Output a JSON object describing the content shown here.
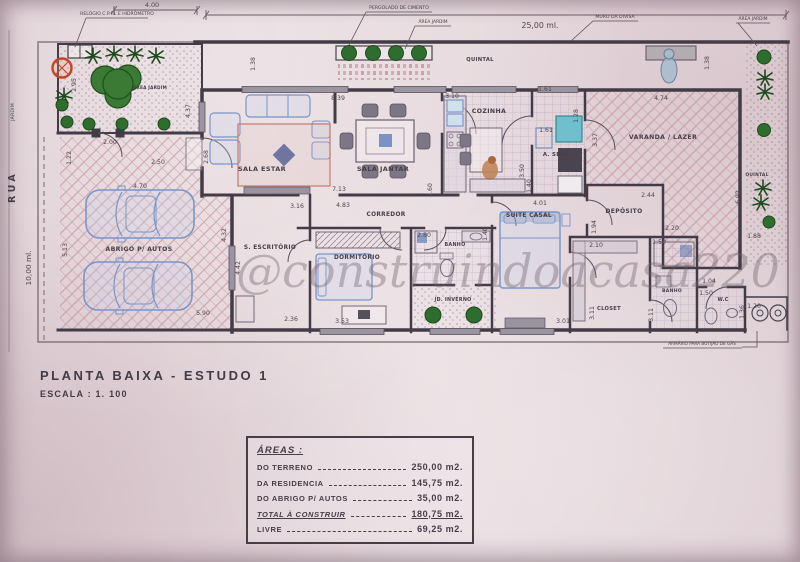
{
  "title_block": {
    "title": "PLANTA BAIXA - ESTUDO 1",
    "scale": "ESCALA : 1. 100"
  },
  "watermark": {
    "text": "@construindoacasa220"
  },
  "areas_table": {
    "heading": "ÁREAS :",
    "rows": [
      {
        "label": "DO TERRENO",
        "value": "250,00 m2.",
        "emphasis": false
      },
      {
        "label": "DA RESIDENCIA",
        "value": "145,75 m2.",
        "emphasis": false
      },
      {
        "label": "DO ABRIGO P/ AUTOS",
        "value": "35,00 m2.",
        "emphasis": false
      },
      {
        "label": "TOTAL À CONSTRUIR",
        "value": "180,75 m2.",
        "emphasis": true
      },
      {
        "label": "LIVRE",
        "value": "69,25 m2.",
        "emphasis": false
      }
    ]
  },
  "plan": {
    "room_labels": [
      {
        "name": "room-label-sala-estar",
        "text": "SALA ESTAR",
        "x": 262,
        "y": 171,
        "size": 6.5
      },
      {
        "name": "room-label-sala-jantar",
        "text": "SALA JANTAR",
        "x": 383,
        "y": 171,
        "size": 6.5
      },
      {
        "name": "room-label-cozinha",
        "text": "COZINHA",
        "x": 489,
        "y": 113,
        "size": 6.2
      },
      {
        "name": "room-label-a-serv",
        "text": "A. SERV",
        "x": 556,
        "y": 156,
        "size": 5.4
      },
      {
        "name": "room-label-varanda",
        "text": "VARANDA / LAZER",
        "x": 663,
        "y": 139,
        "size": 6.2
      },
      {
        "name": "room-label-deposito",
        "text": "DEPÓSITO",
        "x": 624,
        "y": 213,
        "size": 6.0
      },
      {
        "name": "room-label-corredor",
        "text": "CORREDOR",
        "x": 386,
        "y": 216,
        "size": 5.8
      },
      {
        "name": "room-label-escritorio",
        "text": "S. ESCRITÓRIO",
        "x": 270,
        "y": 249,
        "size": 5.8
      },
      {
        "name": "room-label-dormitorio",
        "text": "DORMITÓRIO",
        "x": 357,
        "y": 259,
        "size": 5.8
      },
      {
        "name": "room-label-suite-casal",
        "text": "SUITE CASAL",
        "x": 529,
        "y": 217,
        "size": 5.8
      },
      {
        "name": "room-label-banho-1",
        "text": "BANHO",
        "x": 455,
        "y": 246,
        "size": 4.8
      },
      {
        "name": "room-label-jd-inverno",
        "text": "JD. INVERNO",
        "x": 453,
        "y": 301,
        "size": 4.8
      },
      {
        "name": "room-label-closet",
        "text": "CLOSET",
        "x": 609,
        "y": 310,
        "size": 5.2
      },
      {
        "name": "room-label-banho-2",
        "text": "BANHO",
        "x": 672,
        "y": 292,
        "size": 4.6
      },
      {
        "name": "room-label-wc",
        "text": "W.C",
        "x": 723,
        "y": 301,
        "size": 4.8
      },
      {
        "name": "room-label-abrigo-autos",
        "text": "ABRIGO P/ AUTOS",
        "x": 139,
        "y": 251,
        "size": 6.2
      },
      {
        "name": "room-label-quintal-top",
        "text": "QUINTAL",
        "x": 480,
        "y": 61,
        "size": 5.2
      },
      {
        "name": "room-label-quintal-right",
        "text": "QUINTAL",
        "x": 757,
        "y": 176,
        "size": 4.4
      },
      {
        "name": "room-label-area-jardim",
        "text": "ÁREA JARDIM",
        "x": 150,
        "y": 89,
        "size": 4.2
      }
    ],
    "dimension_labels": [
      {
        "text": "4.00",
        "x": 152,
        "y": 7,
        "rot": 0,
        "size": 6.4
      },
      {
        "text": "25,00 ml.",
        "x": 540,
        "y": 28,
        "rot": 0,
        "size": 7.8
      },
      {
        "text": "10,00 ml.",
        "x": 31,
        "y": 268,
        "rot": -90,
        "size": 7.4
      },
      {
        "text": "2.95",
        "x": 76,
        "y": 85,
        "rot": -90,
        "size": 6.2
      },
      {
        "text": "4.37",
        "x": 190,
        "y": 111,
        "rot": -90,
        "size": 6.2
      },
      {
        "text": "1.38",
        "x": 255,
        "y": 64,
        "rot": -90,
        "size": 6.2
      },
      {
        "text": "2.00",
        "x": 110,
        "y": 144,
        "rot": 0,
        "size": 6.2
      },
      {
        "text": "2.50",
        "x": 158,
        "y": 164,
        "rot": 0,
        "size": 6.2
      },
      {
        "text": "1.22",
        "x": 71,
        "y": 158,
        "rot": -90,
        "size": 6.2
      },
      {
        "text": "4.70",
        "x": 140,
        "y": 188,
        "rot": 0,
        "size": 6.2
      },
      {
        "text": "2.68",
        "x": 208,
        "y": 157,
        "rot": -90,
        "size": 6.2
      },
      {
        "text": "5.13",
        "x": 67,
        "y": 250,
        "rot": -90,
        "size": 6.2
      },
      {
        "text": "4.32",
        "x": 226,
        "y": 235,
        "rot": -90,
        "size": 6.2
      },
      {
        "text": "4.42",
        "x": 240,
        "y": 268,
        "rot": -90,
        "size": 6.2
      },
      {
        "text": "5.90",
        "x": 203,
        "y": 315,
        "rot": 0,
        "size": 6.2
      },
      {
        "text": "2.36",
        "x": 291,
        "y": 321,
        "rot": 0,
        "size": 6.2
      },
      {
        "text": "8.39",
        "x": 338,
        "y": 100,
        "rot": 0,
        "size": 6.2
      },
      {
        "text": "3.16",
        "x": 297,
        "y": 208,
        "rot": 0,
        "size": 6.2
      },
      {
        "text": "4.83",
        "x": 343,
        "y": 207,
        "rot": 0,
        "size": 6.2
      },
      {
        "text": "7.13",
        "x": 339,
        "y": 191,
        "rot": 0,
        "size": 6.2
      },
      {
        "text": "3.10",
        "x": 452,
        "y": 98,
        "rot": 0,
        "size": 6.2
      },
      {
        "text": "3.60",
        "x": 432,
        "y": 190,
        "rot": -90,
        "size": 6.2
      },
      {
        "text": "1.61",
        "x": 545,
        "y": 91,
        "rot": 0,
        "size": 6.2
      },
      {
        "text": "1.61",
        "x": 546,
        "y": 132,
        "rot": 0,
        "size": 6.2
      },
      {
        "text": "1.28",
        "x": 578,
        "y": 116,
        "rot": -90,
        "size": 6.2
      },
      {
        "text": "3.50",
        "x": 524,
        "y": 171,
        "rot": -90,
        "size": 6.2
      },
      {
        "text": "1.40",
        "x": 531,
        "y": 186,
        "rot": -90,
        "size": 6.2
      },
      {
        "text": "3.37",
        "x": 597,
        "y": 140,
        "rot": -90,
        "size": 6.2
      },
      {
        "text": "4.01",
        "x": 540,
        "y": 205,
        "rot": 0,
        "size": 6.2
      },
      {
        "text": "1.40",
        "x": 487,
        "y": 234,
        "rot": -90,
        "size": 6.2
      },
      {
        "text": "2.80",
        "x": 424,
        "y": 237,
        "rot": 0,
        "size": 6.2
      },
      {
        "text": "3.53",
        "x": 342,
        "y": 323,
        "rot": 0,
        "size": 6.2
      },
      {
        "text": "4.74",
        "x": 661,
        "y": 100,
        "rot": 0,
        "size": 6.2
      },
      {
        "text": "1.38",
        "x": 709,
        "y": 63,
        "rot": -90,
        "size": 6.2
      },
      {
        "text": "6.92",
        "x": 740,
        "y": 197,
        "rot": -90,
        "size": 6.2
      },
      {
        "text": "1.88",
        "x": 754,
        "y": 238,
        "rot": 0,
        "size": 6.2
      },
      {
        "text": "2.44",
        "x": 648,
        "y": 197,
        "rot": 0,
        "size": 6.2
      },
      {
        "text": "1.94",
        "x": 596,
        "y": 227,
        "rot": -90,
        "size": 6.2
      },
      {
        "text": "2.20",
        "x": 672,
        "y": 230,
        "rot": 0,
        "size": 6.2
      },
      {
        "text": "2.10",
        "x": 596,
        "y": 247,
        "rot": 0,
        "size": 6.2
      },
      {
        "text": "1.50",
        "x": 659,
        "y": 244,
        "rot": 0,
        "size": 6.2
      },
      {
        "text": "3.11",
        "x": 594,
        "y": 313,
        "rot": -90,
        "size": 6.2
      },
      {
        "text": "3.11",
        "x": 653,
        "y": 315,
        "rot": -90,
        "size": 6.2
      },
      {
        "text": "3.01",
        "x": 563,
        "y": 323,
        "rot": 0,
        "size": 6.2
      },
      {
        "text": "1.04",
        "x": 709,
        "y": 283,
        "rot": 0,
        "size": 6.2
      },
      {
        "text": "1.50",
        "x": 706,
        "y": 295,
        "rot": 0,
        "size": 6.2
      },
      {
        "text": "1.20",
        "x": 754,
        "y": 308,
        "rot": 0,
        "size": 6.2
      },
      {
        "text": "1.36",
        "x": 744,
        "y": 312,
        "rot": -90,
        "size": 6.2
      }
    ],
    "annotations": [
      {
        "name": "note-relogio-cpfl",
        "text": "RELÓGIO C.P.F.L E HIDRÔMETRO",
        "x": 117,
        "y": 15,
        "size": 4.6,
        "underline": [
          86,
          18,
          148
        ],
        "leader": [
          [
            86,
            18
          ],
          [
            75,
            47
          ]
        ]
      },
      {
        "name": "note-pergolado",
        "text": "PERGOLADO DE CIMENTO",
        "x": 399,
        "y": 9,
        "size": 4.6,
        "underline": [
          366,
          12,
          432
        ],
        "leader": [
          [
            366,
            12
          ],
          [
            349,
            45
          ]
        ]
      },
      {
        "name": "note-area-jardim-top",
        "text": "ÁREA JARDIM",
        "x": 433,
        "y": 23,
        "size": 4.4,
        "underline": [
          415,
          26,
          451
        ],
        "leader": [
          [
            415,
            26
          ],
          [
            405,
            49
          ]
        ]
      },
      {
        "name": "note-muro-divisa",
        "text": "MURO DA DIVISA",
        "x": 615,
        "y": 18,
        "size": 4.6,
        "underline": [
          593,
          21,
          638
        ],
        "leader": [
          [
            593,
            21
          ],
          [
            571,
            41
          ]
        ]
      },
      {
        "name": "note-area-jardim-right",
        "text": "ÁREA JARDIM",
        "x": 753,
        "y": 20,
        "size": 4.4,
        "underline": [
          736,
          23,
          770
        ],
        "leader": [
          [
            738,
            23
          ],
          [
            757,
            46
          ]
        ]
      },
      {
        "name": "note-armario-gas",
        "text": "ARMÁRIO PARA BOTIJÃO DE GÁS",
        "x": 702,
        "y": 345,
        "size": 4.2,
        "underline": [
          663,
          348,
          742
        ],
        "leader": [
          [
            757,
            331
          ],
          [
            757,
            347
          ],
          [
            742,
            347
          ]
        ]
      }
    ],
    "side_labels": [
      {
        "name": "street-label",
        "text": "RUA",
        "x": 15,
        "y": 187,
        "rot": -90,
        "size": 9.5,
        "ls": 3.5,
        "bold": true
      },
      {
        "name": "jardim-label",
        "text": "JARDIM",
        "x": 14,
        "y": 112,
        "rot": -90,
        "size": 4.6,
        "ls": 0.5,
        "bold": false
      }
    ]
  },
  "colors": {
    "paper": "#e6d8dc",
    "ink": "#473e49",
    "vegetation_green": "#2f6d2f",
    "furniture_blue": "#7b95c7",
    "tree_ring_red": "#c2452a",
    "watermark_grey": "#6c5d68"
  }
}
